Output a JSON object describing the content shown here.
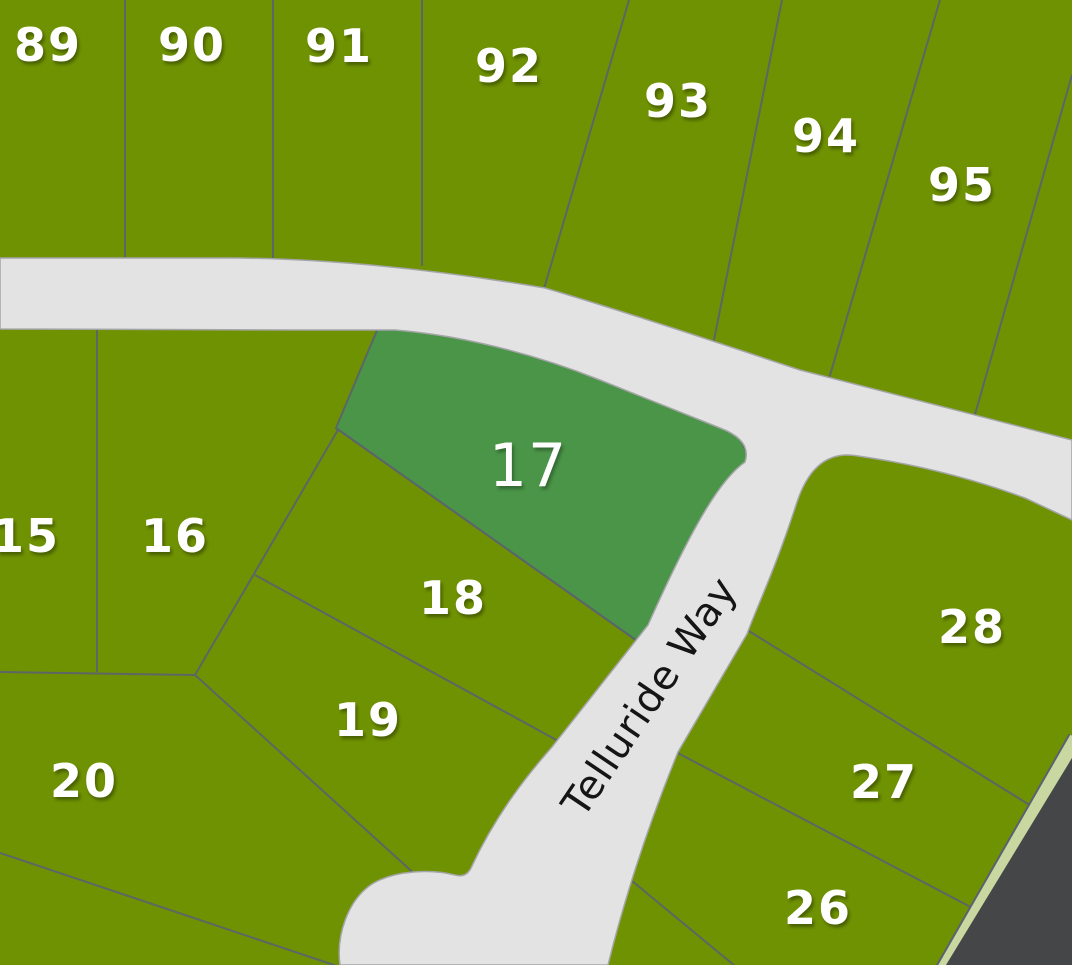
{
  "map": {
    "canvas": {
      "width": 1072,
      "height": 965
    },
    "colors": {
      "lot_green": "#6f9202",
      "highlight_green": "#4a9548",
      "road_gray": "#e3e3e4",
      "road_edge": "#a4a5a7",
      "parcel_line": "#5b6270",
      "offmap_dark": "#454648",
      "greenbelt_strip": "#c9d7a0",
      "lot_label": "#ffffff",
      "road_label": "#151515"
    },
    "road": {
      "name": "Telluride Way",
      "label": {
        "x": 650,
        "y": 697,
        "rotation": -56,
        "font_size": 40
      },
      "path": "M 0,258 L 235,258 C 340,259 450,272 545,288 C 640,316 745,352 800,370 L 1072,440 L 1072,520 L 1025,498 C 960,474 900,462 858,456 Q 815,448 797,502 C 775,570 758,604 747,634 L 678,752 Q 634,860 608,965 L 340,965 C 336,935 348,900 372,884 C 395,870 432,869 455,875 Q 466,878 471,868 C 497,812 530,772 552,747 L 648,625 C 695,520 722,478 745,462 Q 752,440 720,428 C 680,412 640,396 600,380 C 550,360 500,346 450,337 Q 420,332 395,330 L 300,330 L 0,329 Z"
    },
    "highlight_lot": {
      "number": "17",
      "polygon": "383,316 450,330 520,348 590,372 650,398 702,416 740,438 752,464 738,505 720,548 695,590 668,625 650,650 336,428",
      "label": {
        "x": 528,
        "y": 466,
        "font_size": 60
      }
    },
    "parcel_lines": [
      [
        125,
        0,
        125,
        262
      ],
      [
        273,
        0,
        273,
        262
      ],
      [
        422,
        0,
        422,
        266
      ],
      [
        629,
        0,
        543,
        292
      ],
      [
        782,
        0,
        713,
        345
      ],
      [
        940,
        0,
        828,
        382
      ],
      [
        1072,
        75,
        974,
        418
      ],
      [
        97,
        327,
        97,
        672
      ],
      [
        0,
        672,
        195,
        675
      ],
      [
        195,
        675,
        342,
        423
      ],
      [
        255,
        575,
        560,
        742
      ],
      [
        195,
        675,
        418,
        877
      ],
      [
        0,
        853,
        337,
        966
      ],
      [
        336,
        428,
        650,
        650
      ],
      [
        744,
        628,
        1036,
        809
      ],
      [
        672,
        750,
        982,
        913
      ],
      [
        626,
        876,
        735,
        966
      ]
    ],
    "offmap": {
      "strip_line": [
        1076,
        738,
        936,
        982
      ],
      "strip_width": 13,
      "strip_outline_width": 17,
      "dark_polygon": "1072,758 1072,965 946,965"
    },
    "lot_label_font_size": 46,
    "lots": [
      {
        "number": "89",
        "x": 48,
        "y": 45
      },
      {
        "number": "90",
        "x": 192,
        "y": 45
      },
      {
        "number": "91",
        "x": 339,
        "y": 46
      },
      {
        "number": "92",
        "x": 509,
        "y": 66
      },
      {
        "number": "93",
        "x": 678,
        "y": 101
      },
      {
        "number": "94",
        "x": 826,
        "y": 136
      },
      {
        "number": "95",
        "x": 962,
        "y": 185
      },
      {
        "number": "15",
        "x": 26,
        "y": 536
      },
      {
        "number": "16",
        "x": 175,
        "y": 536
      },
      {
        "number": "18",
        "x": 453,
        "y": 598
      },
      {
        "number": "19",
        "x": 368,
        "y": 720
      },
      {
        "number": "20",
        "x": 84,
        "y": 781
      },
      {
        "number": "26",
        "x": 818,
        "y": 908
      },
      {
        "number": "27",
        "x": 884,
        "y": 782
      },
      {
        "number": "28",
        "x": 972,
        "y": 627
      }
    ]
  }
}
